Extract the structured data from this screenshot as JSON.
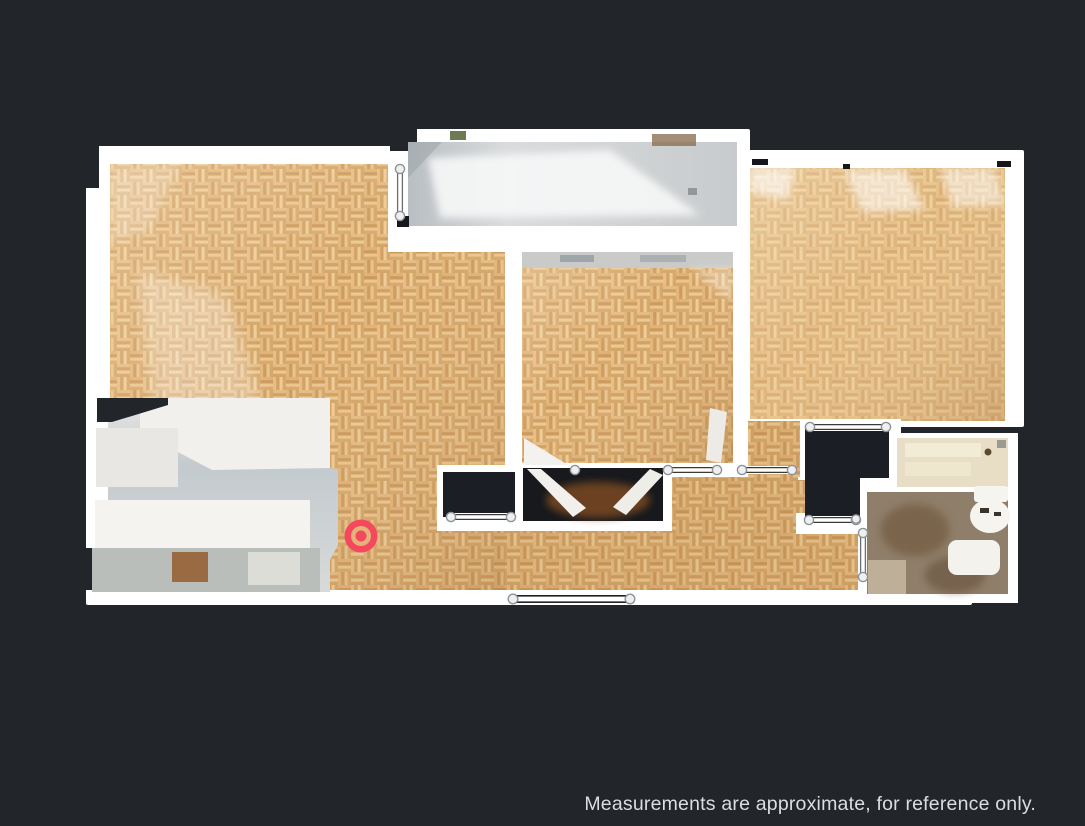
{
  "window": {
    "background_color": "#22252A"
  },
  "disclaimer": {
    "text": "Measurements are approximate, for reference only.",
    "color": "#DCDDE1"
  },
  "floorplan": {
    "wall_color": "#FFFFFF",
    "floor_wood_color": "#D9A96E",
    "unscanned_area_color": "#1B1E24",
    "marker": {
      "color": "#F4485C",
      "x": 361,
      "y": 536
    }
  }
}
